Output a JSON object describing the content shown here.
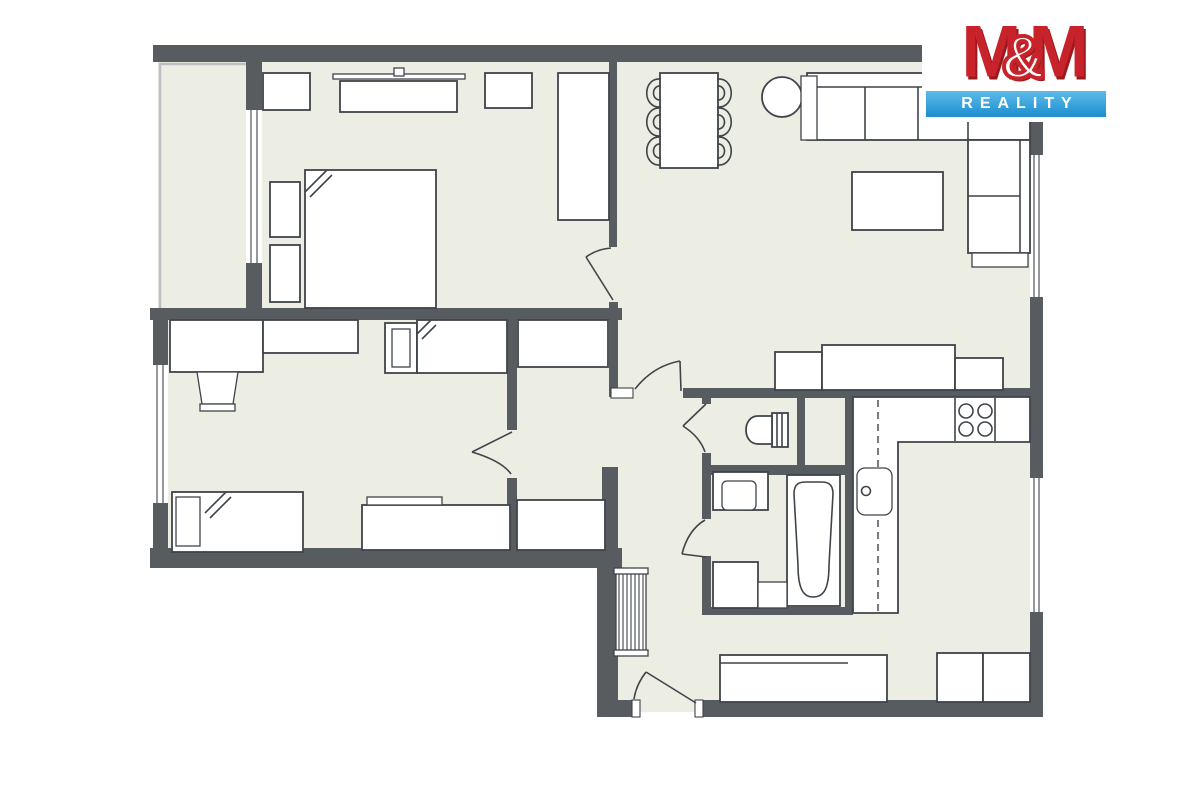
{
  "logo": {
    "m_left": "M",
    "ampersand": "&",
    "m_right": "M",
    "reality": "REALITY"
  },
  "colors": {
    "wall": "#575c61",
    "floor": "#ecede3",
    "line": "#3f444a",
    "furniture": "#ffffff",
    "balcony_line": "#bcc0c3",
    "logo_red": "#c8232a",
    "logo_red_dark": "#9a191e",
    "logo_blue_light": "#5cbbe9",
    "logo_blue": "#1d8dcf",
    "background": "#ffffff"
  }
}
